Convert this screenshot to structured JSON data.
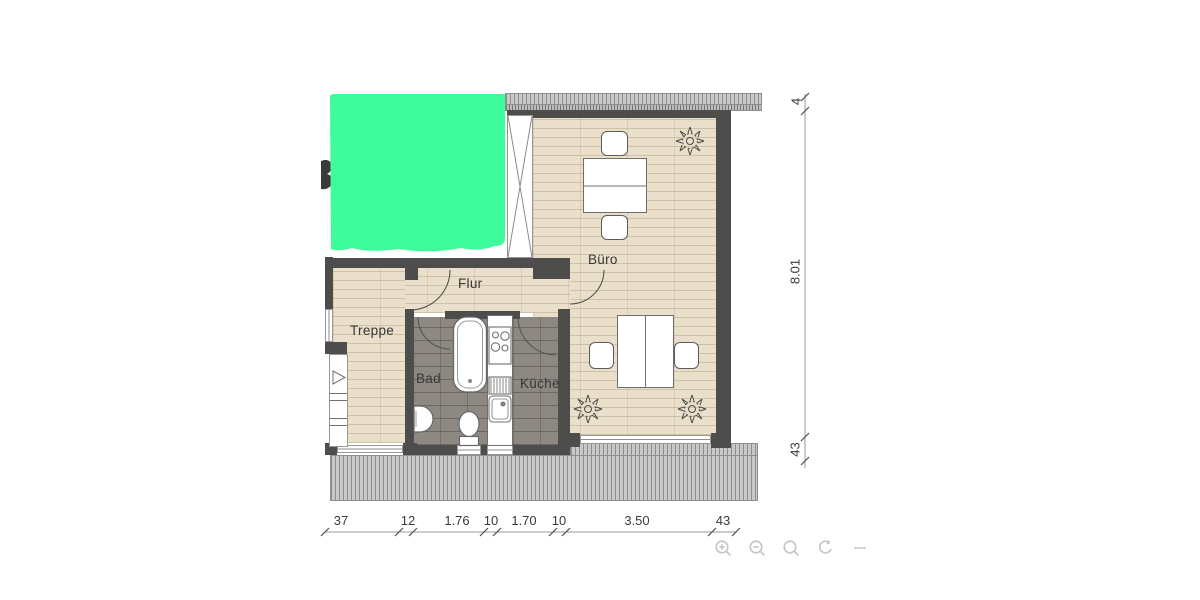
{
  "plan": {
    "room_labels": {
      "treppe": "Treppe",
      "flur": "Flur",
      "buero": "Büro",
      "bad": "Bad",
      "kueche": "Küche"
    },
    "dimensions": {
      "bottom": [
        "37",
        "12",
        "1.76",
        "10",
        "1.70",
        "10",
        "3.50",
        "43"
      ],
      "right": [
        "4",
        "8.01",
        "43"
      ]
    },
    "colors": {
      "wall": "#4d4d4b",
      "wood_floor": "#e9dfca",
      "tile_floor": "#8d8882",
      "redaction_green": "#3efb9b",
      "dimension_text": "#3a3a3a",
      "toolbar_icon": "#c4c4c4"
    }
  },
  "toolbar": {
    "icons": [
      "zoom-in",
      "zoom-out",
      "search",
      "rotate"
    ]
  }
}
